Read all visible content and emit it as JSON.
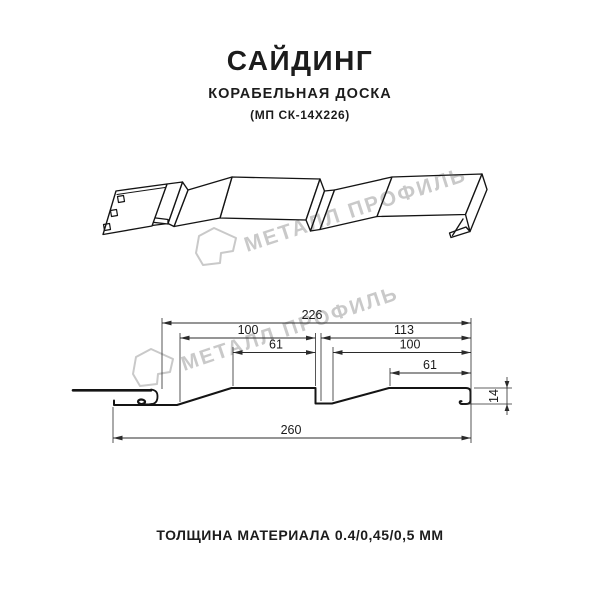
{
  "header": {
    "title": "САЙДИНГ",
    "subtitle": "КОРАБЕЛЬНАЯ ДОСКА",
    "model_code": "(МП СК-14Х226)"
  },
  "watermark": {
    "text": "МЕТАЛЛ ПРОФИЛЬ",
    "color": "#c9c9c9"
  },
  "dims": {
    "d226": "226",
    "d100_left": "100",
    "d61_left": "61",
    "d113": "113",
    "d100_right": "100",
    "d61_right": "61",
    "d260": "260",
    "d14": "14"
  },
  "footer": {
    "material_thickness": "ТОЛЩИНА МАТЕРИАЛА 0.4/0,45/0,5 ММ"
  },
  "colors": {
    "line": "#141414",
    "dim_line": "#2b2b2b",
    "watermark": "#c9c9c9"
  }
}
